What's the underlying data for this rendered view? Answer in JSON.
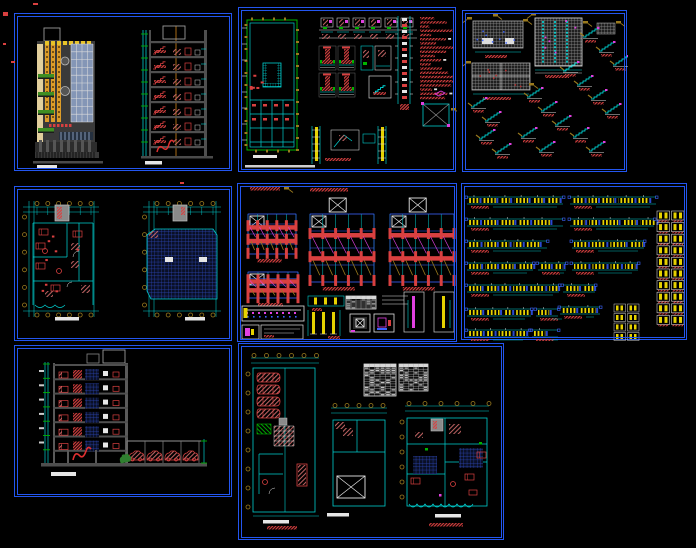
{
  "canvas": {
    "width": 696,
    "height": 548,
    "background": "#000000"
  },
  "palette": {
    "border_blue": "#2356f0",
    "cyan": "#00cfcf",
    "bright_cyan": "#00ffff",
    "green": "#00b400",
    "plant_green": "#3f8f22",
    "red": "#d94040",
    "red_hatch": "#c86868",
    "magenta": "#e040e0",
    "yellow": "#e6d200",
    "olive": "#9a7a1e",
    "orange": "#dd9c28",
    "orange_line": "#a86a14",
    "gray_struct": "#4f4f4f",
    "gray_light": "#9a9a9a",
    "window_blue": "#8496b6",
    "dark_blue": "#2c46b8",
    "white": "#e6e6e6",
    "cream": "#e2cf9c"
  },
  "outside_marks": [
    {
      "x": 33,
      "y": 3,
      "w": 5,
      "h": 2
    },
    {
      "x": 3,
      "y": 12,
      "w": 5,
      "h": 4
    },
    {
      "x": 3,
      "y": 43,
      "w": 3,
      "h": 2
    },
    {
      "x": 11,
      "y": 61,
      "w": 4,
      "h": 2
    },
    {
      "x": 180,
      "y": 182,
      "w": 4,
      "h": 2
    }
  ],
  "panels": [
    {
      "id": "p1",
      "name": "elevation-and-section-sheet",
      "type": "elevation_section",
      "x": 14,
      "y": 13,
      "w": 218,
      "h": 158,
      "params": {
        "floors": 7
      }
    },
    {
      "id": "p2",
      "name": "foundation-plan-and-details-sheet",
      "type": "foundation_details",
      "x": 238,
      "y": 7,
      "w": 218,
      "h": 165,
      "params": {
        "note_lines": 20,
        "footing_details": 4,
        "wall_details": 6
      }
    },
    {
      "id": "p3",
      "name": "slab-and-stair-details-sheet",
      "type": "slabs_stairs",
      "x": 462,
      "y": 10,
      "w": 165,
      "h": 162,
      "params": {
        "stairs": [
          [
            120,
            18
          ],
          [
            136,
            32
          ],
          [
            150,
            46
          ],
          [
            100,
            52
          ],
          [
            114,
            66
          ],
          [
            128,
            80
          ],
          [
            142,
            94
          ],
          [
            64,
            78
          ],
          [
            78,
            92
          ],
          [
            92,
            106
          ],
          [
            58,
            118
          ],
          [
            76,
            132
          ],
          [
            110,
            118
          ],
          [
            126,
            132
          ],
          [
            16,
            120
          ],
          [
            32,
            134
          ],
          [
            8,
            88
          ],
          [
            22,
            102
          ]
        ]
      }
    },
    {
      "id": "p4",
      "name": "floor-plan-and-roof-plan-sheet",
      "type": "two_plans",
      "x": 14,
      "y": 186,
      "w": 218,
      "h": 155,
      "params": {}
    },
    {
      "id": "p5",
      "name": "framing-plans-sheet",
      "type": "framing",
      "x": 237,
      "y": 183,
      "w": 220,
      "h": 159,
      "params": {
        "plans": 3
      }
    },
    {
      "id": "p6",
      "name": "beam-elevation-schedule-sheet",
      "type": "beam_rows",
      "x": 461,
      "y": 183,
      "w": 226,
      "h": 157,
      "params": {
        "rows": [
          [
            5,
            13,
            96
          ],
          [
            108,
            13,
            86
          ],
          [
            5,
            35,
            96
          ],
          [
            108,
            35,
            84
          ],
          [
            5,
            57,
            80
          ],
          [
            110,
            57,
            72
          ],
          [
            5,
            79,
            66
          ],
          [
            76,
            79,
            28
          ],
          [
            110,
            79,
            66
          ],
          [
            5,
            101,
            92
          ],
          [
            101,
            101,
            32
          ],
          [
            5,
            125,
            64
          ],
          [
            74,
            125,
            22
          ],
          [
            98,
            123,
            40
          ],
          [
            5,
            146,
            62
          ],
          [
            70,
            146,
            26
          ]
        ],
        "section_grid_rows": 10,
        "section_grid_cols": 2
      }
    },
    {
      "id": "p7",
      "name": "building-section-with-parking-sheet",
      "type": "section_parking",
      "x": 14,
      "y": 345,
      "w": 218,
      "h": 152,
      "params": {
        "floors": 6,
        "cars": 4
      }
    },
    {
      "id": "p8",
      "name": "floor-plans-and-schedule-tables-sheet",
      "type": "plans_tables",
      "x": 238,
      "y": 343,
      "w": 266,
      "h": 197,
      "params": {
        "cars": 4,
        "tables": 2
      }
    }
  ]
}
